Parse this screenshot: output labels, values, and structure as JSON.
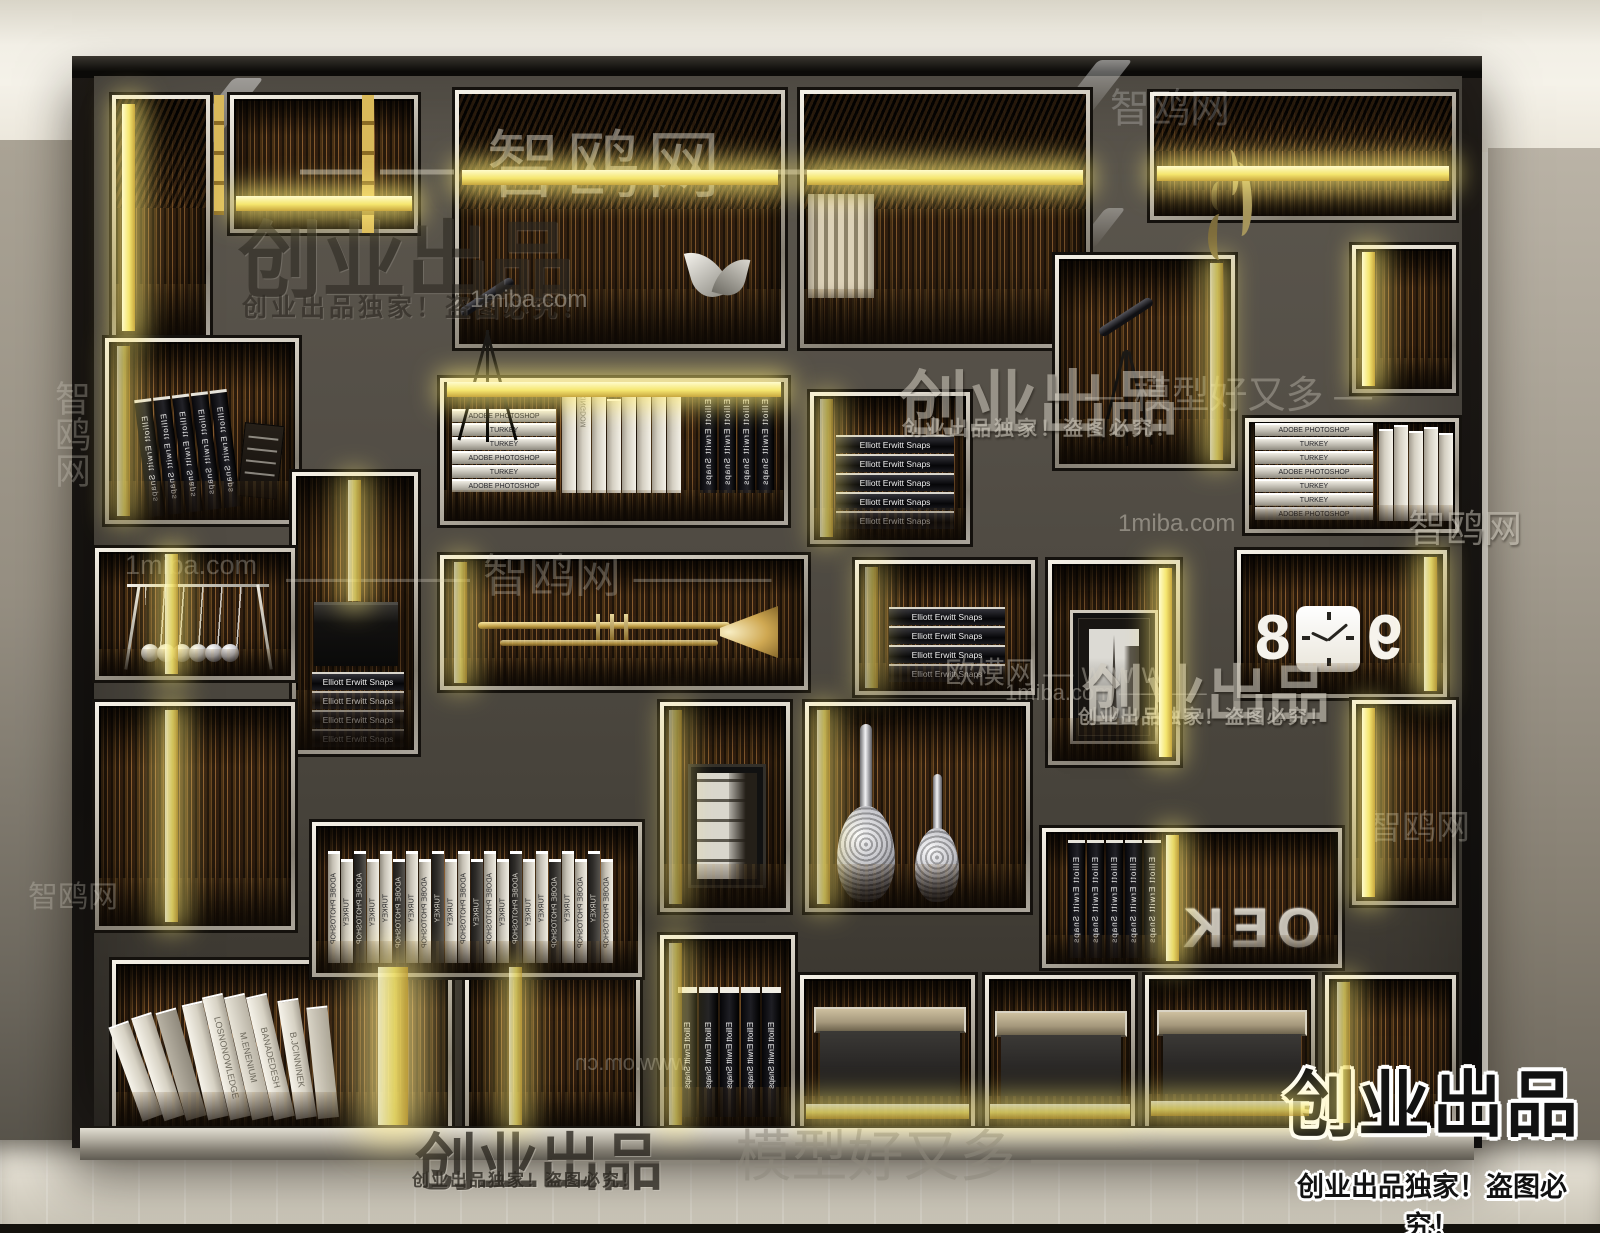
{
  "watermarks": {
    "zhiou": "智鸥网",
    "zhiou_banner": "—— 智鸥网 ——",
    "zhiou_dashes": "———— 智鸥网 ———",
    "miba": "1miba.com",
    "miba_dashes": "1miba.com ————",
    "oumo_www": "欧模网 — w w w",
    "www_cn": "www.om.cn",
    "moxing_banner": "——— 模型好又多 ———",
    "moxing_dashes": "— 模型好又多 —",
    "chuangye": "创业出品",
    "chuangye_slogan": "创业出品独家！盗图必究！"
  },
  "logo": {
    "title": "创业出品",
    "slogan": "创业出品独家！盗图必究！"
  },
  "books": {
    "elliott": "Elliott Erwitt Snaps",
    "adobe": "ADOBE PHOTOSHOP",
    "turkey": "TURKEY",
    "kingdom": "KINGDOM",
    "elliott5": [
      "Elliott Erwitt Snaps",
      "Elliott Erwitt Snaps",
      "Elliott Erwitt Snaps",
      "Elliott Erwitt Snaps",
      "Elliott Erwitt Snaps"
    ],
    "elliott4": [
      "Elliott Erwitt Snaps",
      "Elliott Erwitt Snaps",
      "Elliott Erwitt Snaps",
      "Elliott Erwitt Snaps"
    ],
    "m4_stack": [
      "ADOBE PHOTOSHOP",
      "TURKEY",
      "TURKEY",
      "ADOBE PHOTOSHOP",
      "TURKEY",
      "ADOBE PHOTOSHOP"
    ],
    "m9_stack": [
      "ADOBE PHOTOSHOP",
      "TURKEY",
      "TURKEY",
      "ADOBE PHOTOSHOP",
      "TURKEY",
      "TURKEY",
      "ADOBE PHOTOSHOP"
    ],
    "adobe_row": [
      "ADOBE PHOTOSHOP",
      "TURKEY",
      "ADOBE PHOTOSHOP",
      "TURKEY",
      "TURKEY",
      "ADOBE PHOTOSHOP",
      "TURKEY",
      "ADOBE PHOTOSHOP",
      "TURKEY",
      "TURKEY",
      "ADOBE PHOTOSHOP",
      "TURKEY",
      "ADOBE PHOTOSHOP",
      "TURKEY",
      "ADOBE PHOTOSHOP",
      "TURKEY",
      "TURKEY",
      "ADOBE PHOTOSHOP",
      "TURKEY",
      "ADOBE PHOTOSHOP",
      "TURKEY",
      "ADOBE PHOTOSHOP"
    ],
    "art_spines": [
      "",
      "",
      "",
      "",
      "LOSNONOWLEDGE",
      "M.ENENIUM",
      "BANADEDESH",
      "B.JCINNINEK",
      ""
    ],
    "binders5": [
      "Elliott Erwitt Snaps",
      "Elliott Erwitt Snaps",
      "Elliott Erwitt Snaps",
      "Elliott Erwitt Snaps",
      "Elliott Erwitt Snaps"
    ]
  },
  "decor": {
    "metal_letters": "OEK",
    "clock_digit_left": "8",
    "clock_digit_right": "9"
  },
  "colors": {
    "led_yellow": "#f5e66f",
    "wood_brown": "#3a2712",
    "frame_black": "#0e0c0a",
    "partition_gray": "#534e46",
    "trim_silver": "#d9d4c9",
    "ceiling": "#f2efe6",
    "wall_gray": "#a9a296",
    "floor": "#ddd8cb"
  }
}
